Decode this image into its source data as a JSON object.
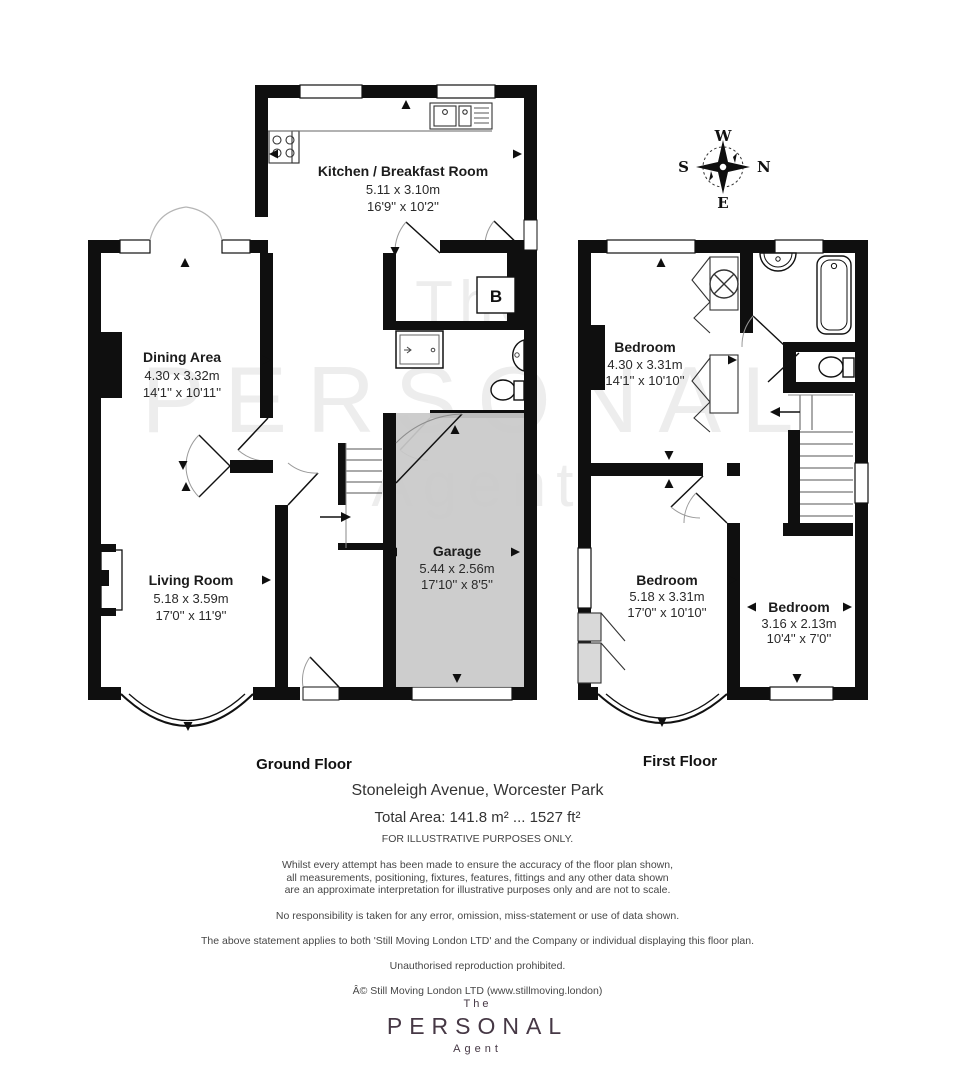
{
  "watermark": {
    "line1": "The",
    "line2": "PERSONAL",
    "line3": "Agent"
  },
  "compass": {
    "w": "W",
    "n": "N",
    "s": "S",
    "e": "E"
  },
  "floors": {
    "ground": {
      "label": "Ground Floor",
      "rooms": {
        "kitchen": {
          "name": "Kitchen / Breakfast Room",
          "metric": "5.11 x 3.10m",
          "imperial": "16'9'' x 10'2''"
        },
        "dining": {
          "name": "Dining Area",
          "metric": "4.30 x 3.32m",
          "imperial": "14'1'' x 10'11''"
        },
        "living": {
          "name": "Living Room",
          "metric": "5.18 x 3.59m",
          "imperial": "17'0'' x 11'9''"
        },
        "garage": {
          "name": "Garage",
          "metric": "5.44 x 2.56m",
          "imperial": "17'10'' x 8'5''"
        },
        "boiler": {
          "label": "B"
        }
      }
    },
    "first": {
      "label": "First Floor",
      "rooms": {
        "bedroom1": {
          "name": "Bedroom",
          "metric": "4.30 x 3.31m",
          "imperial": "14'1'' x 10'10''"
        },
        "bedroom2": {
          "name": "Bedroom",
          "metric": "5.18 x 3.31m",
          "imperial": "17'0'' x 10'10''"
        },
        "bedroom3": {
          "name": "Bedroom",
          "metric": "3.16 x 2.13m",
          "imperial": "10'4'' x 7'0''"
        }
      }
    }
  },
  "footer": {
    "address": "Stoneleigh Avenue, Worcester Park",
    "total_area": "Total Area: 141.8 m² ... 1527 ft²",
    "illustrative": "FOR ILLUSTRATIVE PURPOSES ONLY.",
    "disclaimer_line1": "Whilst every attempt has been made to ensure the accuracy of the floor plan shown,",
    "disclaimer_line2": "all measurements, positioning, fixtures, features, fittings and any other data shown",
    "disclaimer_line3": "are an approximate interpretation for illustrative purposes only and are not to scale.",
    "disclaimer_no_resp": "No responsibility is taken for any error, omission, miss-statement or use of data shown.",
    "disclaimer_statement": "The above statement applies to both 'Still Moving London LTD' and the Company or individual displaying this floor plan.",
    "disclaimer_repro": "Unauthorised reproduction prohibited.",
    "copyright": "Â© Still Moving London LTD (www.stillmoving.london)"
  },
  "logo": {
    "the": "The",
    "personal": "PERSONAL",
    "agent": "Agent"
  },
  "colors": {
    "wall": "#0f0f0f",
    "garage_fill": "#c9c9c9",
    "watermark": "#ededed",
    "logo": "#463845"
  }
}
